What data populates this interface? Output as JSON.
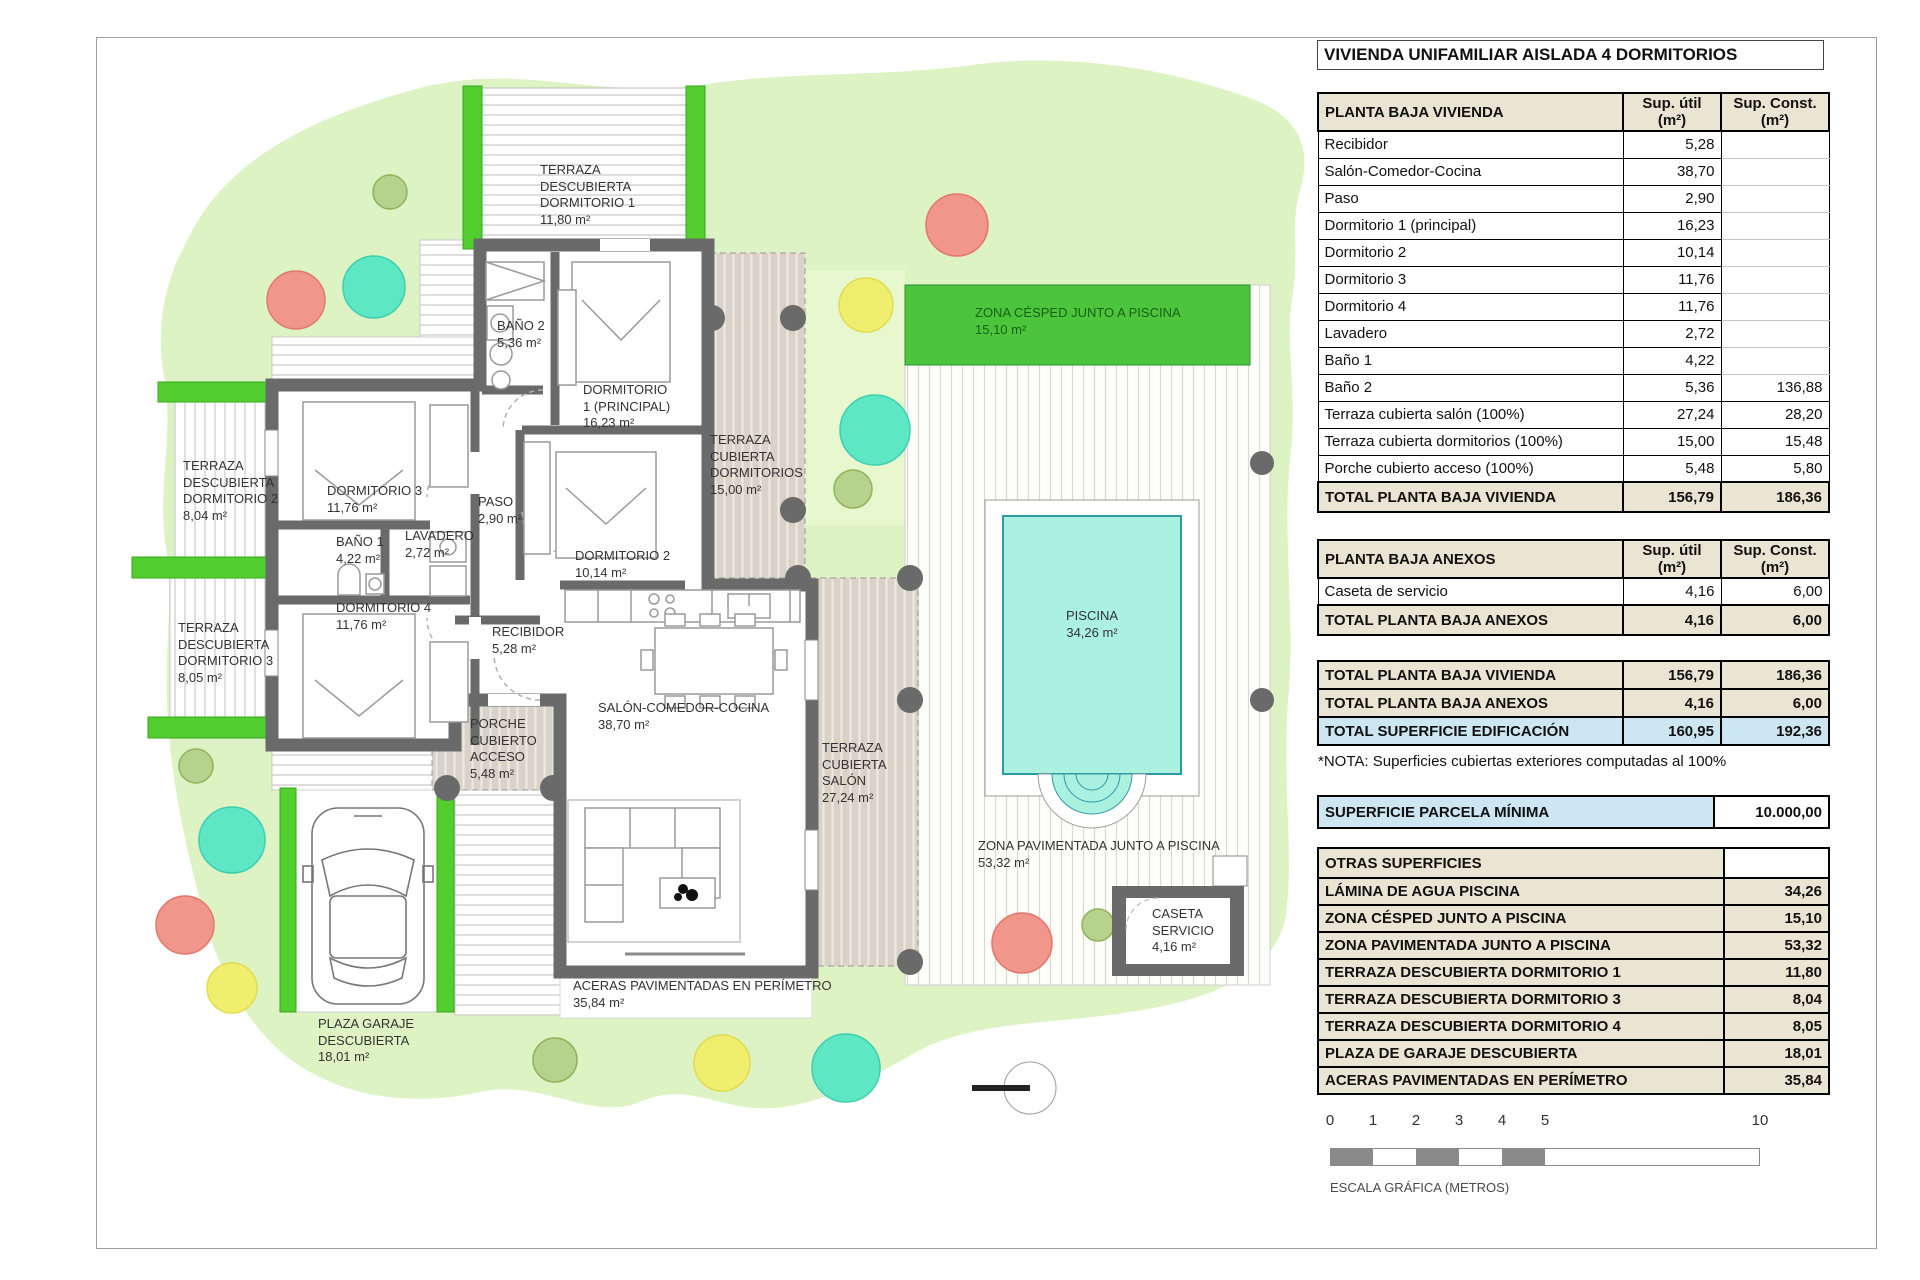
{
  "title": "VIVIENDA UNIFAMILIAR AISLADA 4 DORMITORIOS",
  "colors": {
    "parcel": "#ddf3c4",
    "hedge": "#52cf2e",
    "cesped": "#4cc43c",
    "pool_water": "#aaf1e0",
    "wall": "#6a6a6a",
    "terraza_tan": "#d9d2c8",
    "header_beige": "#eae5d3",
    "highlight_blue": "#cde7f2"
  },
  "tables": {
    "col_util": "Sup. útil",
    "col_const": "Sup. Const.",
    "col_m2": "(m²)",
    "planta_baja": {
      "header": "PLANTA BAJA VIVIENDA",
      "rows": [
        {
          "label": "Recibidor",
          "util": "5,28",
          "const": ""
        },
        {
          "label": "Salón-Comedor-Cocina",
          "util": "38,70",
          "const": ""
        },
        {
          "label": "Paso",
          "util": "2,90",
          "const": ""
        },
        {
          "label": "Dormitorio 1 (principal)",
          "util": "16,23",
          "const": ""
        },
        {
          "label": "Dormitorio 2",
          "util": "10,14",
          "const": ""
        },
        {
          "label": "Dormitorio 3",
          "util": "11,76",
          "const": ""
        },
        {
          "label": "Dormitorio 4",
          "util": "11,76",
          "const": ""
        },
        {
          "label": "Lavadero",
          "util": "2,72",
          "const": ""
        },
        {
          "label": "Baño 1",
          "util": "4,22",
          "const": ""
        },
        {
          "label": "Baño 2",
          "util": "5,36",
          "const": "136,88"
        },
        {
          "label": "Terraza cubierta salón (100%)",
          "util": "27,24",
          "const": "28,20"
        },
        {
          "label": "Terraza cubierta dormitorios (100%)",
          "util": "15,00",
          "const": "15,48"
        },
        {
          "label": "Porche cubierto acceso (100%)",
          "util": "5,48",
          "const": "5,80"
        }
      ],
      "total": {
        "label": "TOTAL PLANTA BAJA VIVIENDA",
        "util": "156,79",
        "const": "186,36"
      }
    },
    "anexos": {
      "header": "PLANTA BAJA ANEXOS",
      "rows": [
        {
          "label": "Caseta de servicio",
          "util": "4,16",
          "const": "6,00"
        }
      ],
      "total": {
        "label": "TOTAL PLANTA BAJA ANEXOS",
        "util": "4,16",
        "const": "6,00"
      }
    },
    "summary": {
      "rows": [
        {
          "label": "TOTAL PLANTA BAJA VIVIENDA",
          "util": "156,79",
          "const": "186,36"
        },
        {
          "label": "TOTAL PLANTA BAJA ANEXOS",
          "util": "4,16",
          "const": "6,00"
        },
        {
          "label": "TOTAL SUPERFICIE EDIFICACIÓN",
          "util": "160,95",
          "const": "192,36"
        }
      ],
      "note": "*NOTA: Superficies cubiertas exteriores computadas al 100%"
    },
    "parcela": {
      "label": "SUPERFICIE PARCELA MÍNIMA",
      "value": "10.000,00"
    },
    "otras": {
      "header": "OTRAS SUPERFICIES",
      "rows": [
        {
          "label": "LÁMINA DE AGUA PISCINA",
          "value": "34,26"
        },
        {
          "label": "ZONA CÉSPED JUNTO A PISCINA",
          "value": "15,10"
        },
        {
          "label": "ZONA PAVIMENTADA JUNTO A PISCINA",
          "value": "53,32"
        },
        {
          "label": "TERRAZA DESCUBIERTA DORMITORIO 1",
          "value": "11,80"
        },
        {
          "label": "TERRAZA DESCUBIERTA DORMITORIO 3",
          "value": "8,04"
        },
        {
          "label": "TERRAZA DESCUBIERTA DORMITORIO 4",
          "value": "8,05"
        },
        {
          "label": "PLAZA DE GARAJE DESCUBIERTA",
          "value": "18,01"
        },
        {
          "label": "ACERAS PAVIMENTADAS EN PERÍMETRO",
          "value": "35,84"
        }
      ]
    }
  },
  "scale_bar": {
    "ticks": [
      "0",
      "1",
      "2",
      "3",
      "4",
      "5",
      "10"
    ],
    "label": "ESCALA GRÁFICA (METROS)"
  },
  "plan": {
    "labels": {
      "terraza_desc_dorm1": "TERRAZA\nDESCUBIERTA\nDORMITORIO 1\n11,80 m²",
      "bano2": "BAÑO 2\n5,36 m²",
      "dorm1": "DORMITORIO\n1 (PRINCIPAL)\n16,23 m²",
      "terraza_cub_dorm": "TERRAZA\nCUBIERTA\nDORMITORIOS\n15,00 m²",
      "zona_cesped": "ZONA CÉSPED JUNTO A PISCINA\n15,10 m²",
      "terraza_desc_dorm2": "TERRAZA\nDESCUBIERTA\nDORMITORIO 2\n8,04 m²",
      "dorm3": "DORMITORIO 3\n11,76 m²",
      "paso": "PASO\n2,90 m²",
      "bano1": "BAÑO 1\n4,22 m²",
      "lavadero": "LAVADERO\n2,72 m²",
      "dorm2": "DORMITORIO 2\n10,14 m²",
      "terraza_desc_dorm3": "TERRAZA\nDESCUBIERTA\nDORMITORIO 3\n8,05 m²",
      "dorm4": "DORMITORIO 4\n11,76 m²",
      "recibidor": "RECIBIDOR\n5,28 m²",
      "piscina": "PISCINA\n34,26 m²",
      "salon": "SALÓN-COMEDOR-COCINA\n38,70 m²",
      "porche": "PORCHE\nCUBIERTO\nACCESO\n5,48 m²",
      "terraza_cub_salon": "TERRAZA\nCUBIERTA\nSALÓN\n27,24 m²",
      "zona_pavimentada": "ZONA PAVIMENTADA JUNTO A PISCINA\n53,32 m²",
      "caseta": "CASETA\nSERVICIO\n4,16 m²",
      "aceras": "ACERAS PAVIMENTADAS EN PERÍMETRO\n35,84 m²",
      "plaza_garaje": "PLAZA GARAJE\nDESCUBIERTA\n18,01 m²"
    }
  }
}
